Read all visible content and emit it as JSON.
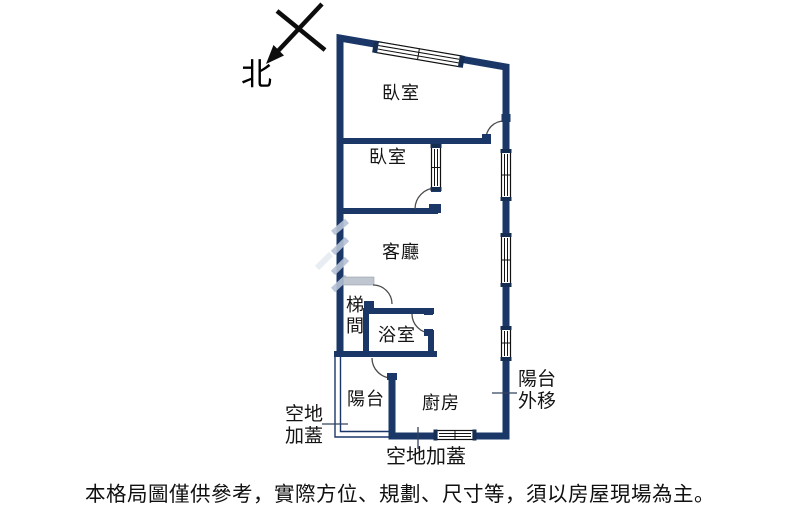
{
  "compass": {
    "north_label": "北"
  },
  "rooms": {
    "bedroom1": {
      "label": "臥室"
    },
    "bedroom2": {
      "label": "臥室"
    },
    "living_room": {
      "label": "客廳"
    },
    "stairwell": {
      "label": "梯間"
    },
    "bathroom": {
      "label": "浴室"
    },
    "balcony": {
      "label": "陽台"
    },
    "kitchen": {
      "label": "廚房"
    }
  },
  "annotations": {
    "open_land_left": {
      "label": "空地加蓋"
    },
    "open_land_bottom": {
      "label": "空地加蓋"
    },
    "balcony_extended": {
      "label": "陽台外移"
    }
  },
  "disclaimer": "本格局圖僅供參考，實際方位、規劃、尺寸等，須以房屋現場為主。",
  "colors": {
    "wall": "#1a3768",
    "window_cap": "#152e52",
    "door_arc": "#4a4a4a",
    "threshold_gray": "#bfc6cf",
    "watermark": "#b5c2d6"
  }
}
